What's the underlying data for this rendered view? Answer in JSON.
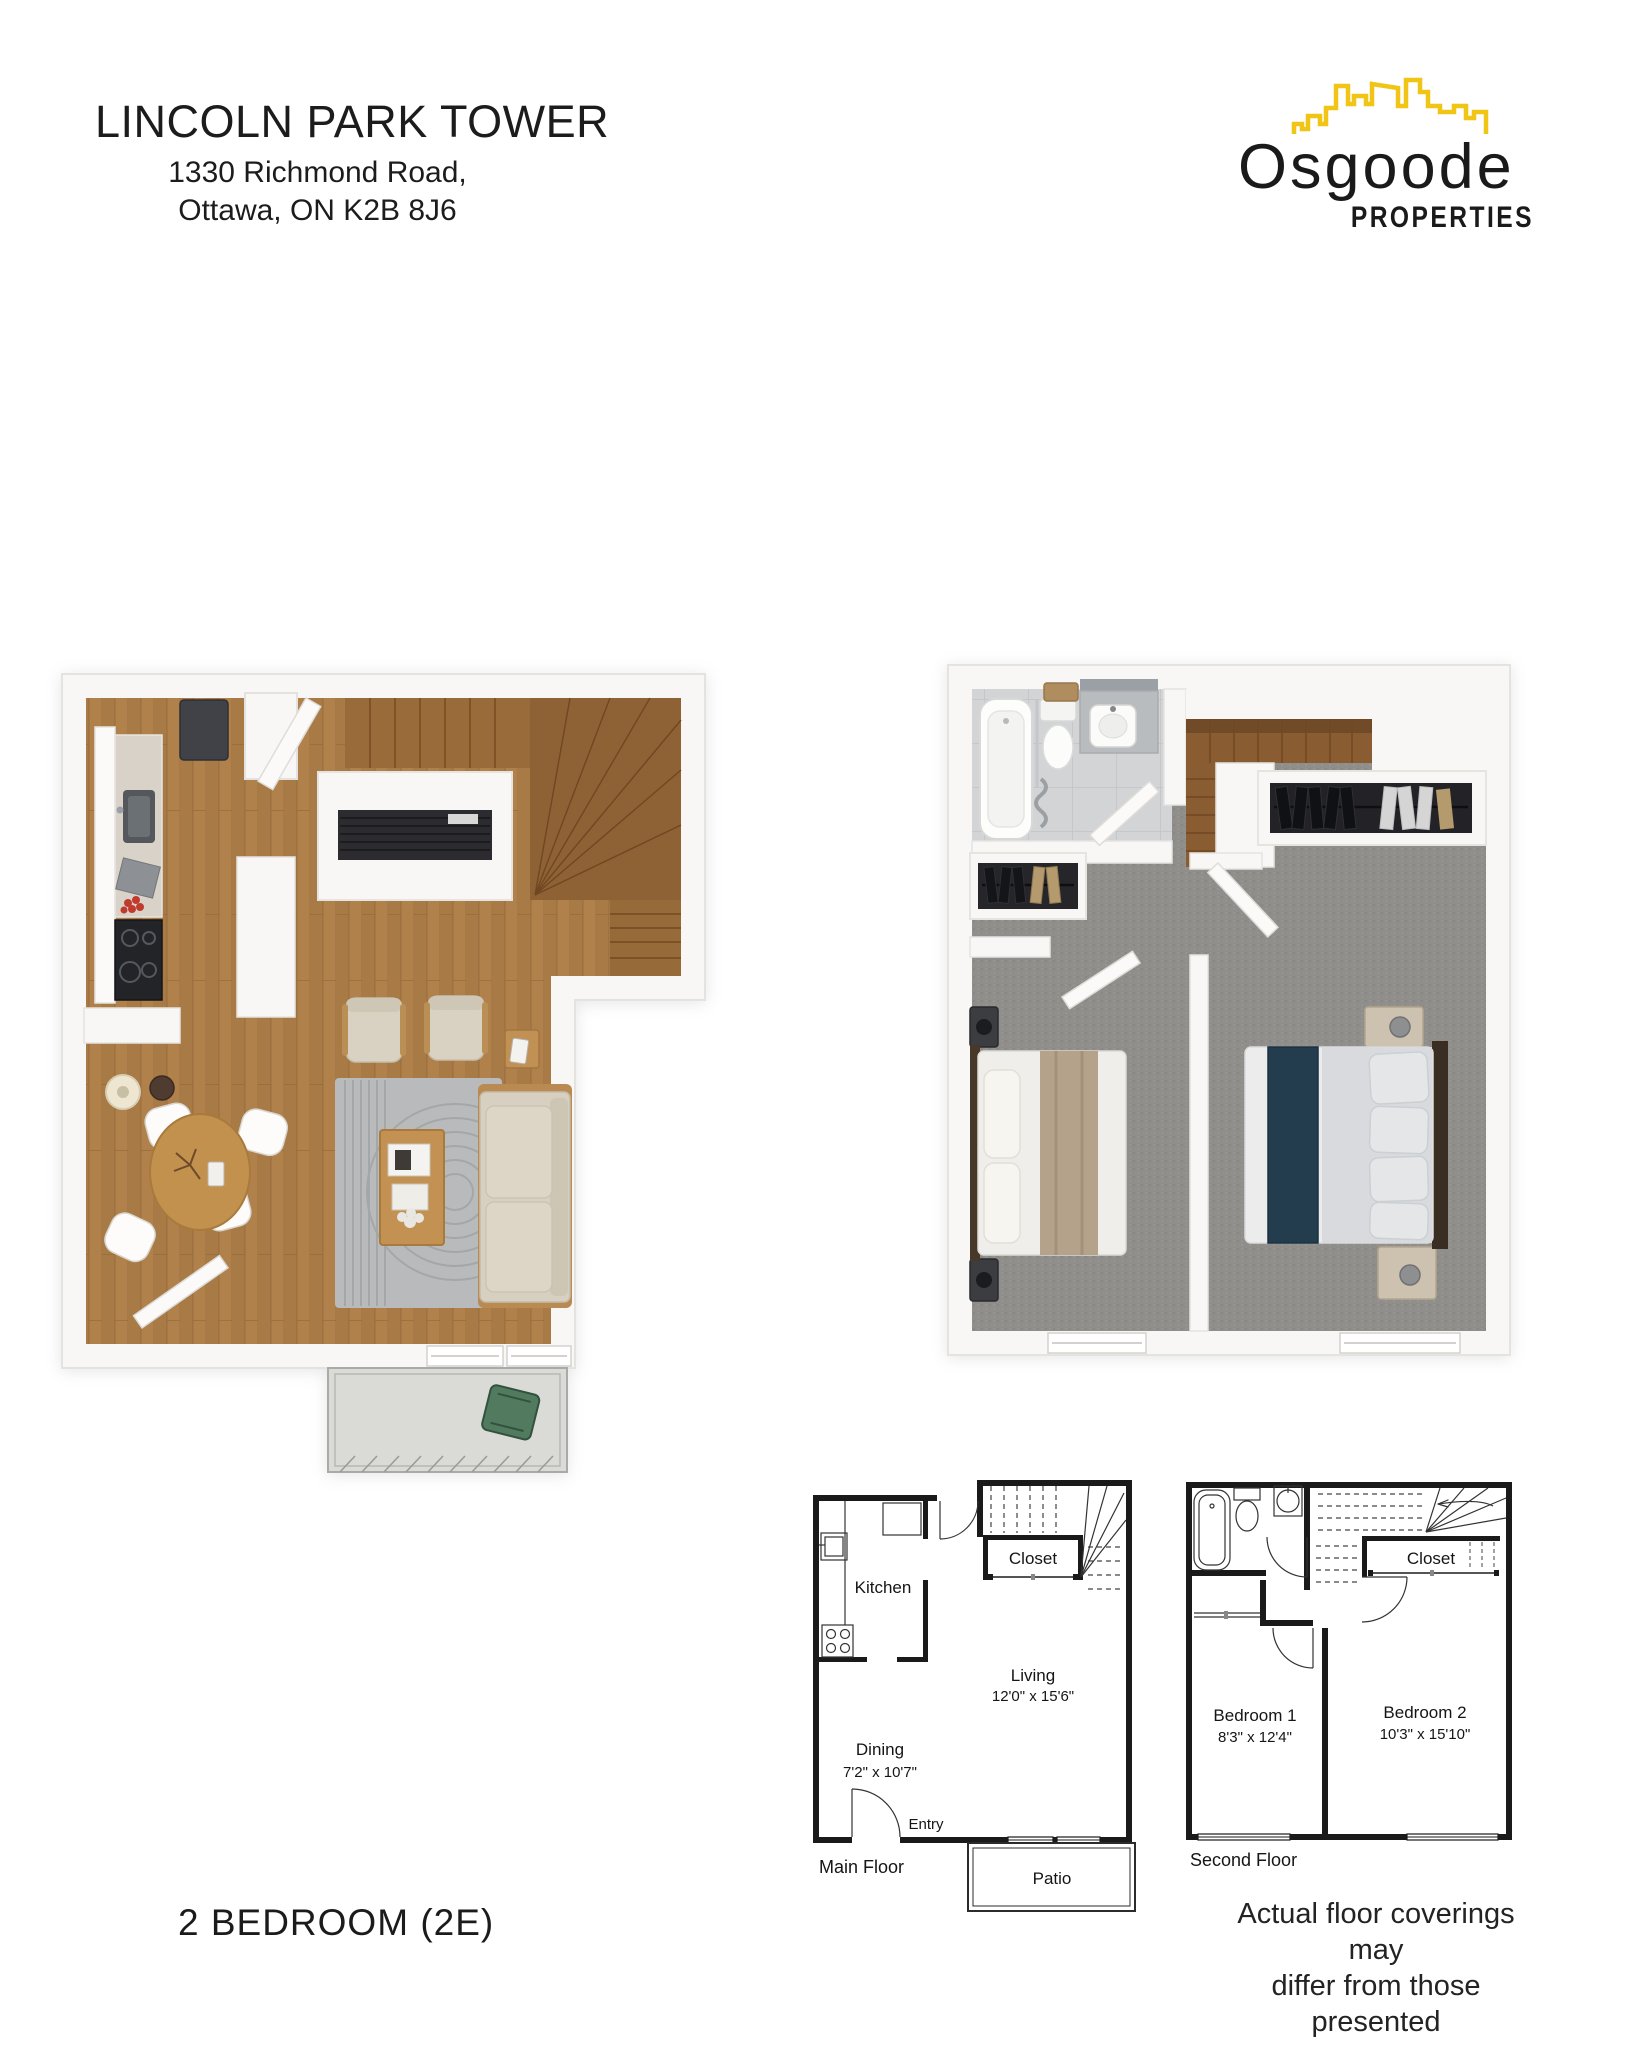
{
  "page": {
    "background": "#ffffff"
  },
  "header": {
    "building_name": "LINCOLN PARK TOWER",
    "address_line1": "1330 Richmond Road,",
    "address_line2": "Ottawa, ON K2B 8J6"
  },
  "brand": {
    "wordmark": "Osgoode",
    "tagline": "PROPERTIES",
    "skyline_color": "#F0C516",
    "text_color": "#1A1A1A"
  },
  "renders": {
    "main_floor_3d": {
      "floor_color": "#B0814B",
      "rooms": "Kitchen, Dining, Living, Stairs, Balcony"
    },
    "second_floor_3d": {
      "carpet_color": "#8F8E8B",
      "rooms": "Bathroom, Closets, Bedroom 1, Bedroom 2, Stairs"
    }
  },
  "plans_2d": {
    "main_floor": {
      "floor_label": "Main Floor",
      "kitchen_label": "Kitchen",
      "closet_label": "Closet",
      "living_label": "Living",
      "living_dims": "12'0\" x 15'6\"",
      "dining_label": "Dining",
      "dining_dims": "7'2\" x 10'7\"",
      "entry_label": "Entry",
      "patio_label": "Patio"
    },
    "second_floor": {
      "floor_label": "Second Floor",
      "closet_label": "Closet",
      "bedroom1_label": "Bedroom 1",
      "bedroom1_dims": "8'3\" x 12'4\"",
      "bedroom2_label": "Bedroom 2",
      "bedroom2_dims": "10'3\" x 15'10\""
    }
  },
  "footer": {
    "unit_type": "2 BEDROOM (2E)",
    "disclaimer_line1": "Actual floor coverings may",
    "disclaimer_line2": "differ from those presented"
  }
}
